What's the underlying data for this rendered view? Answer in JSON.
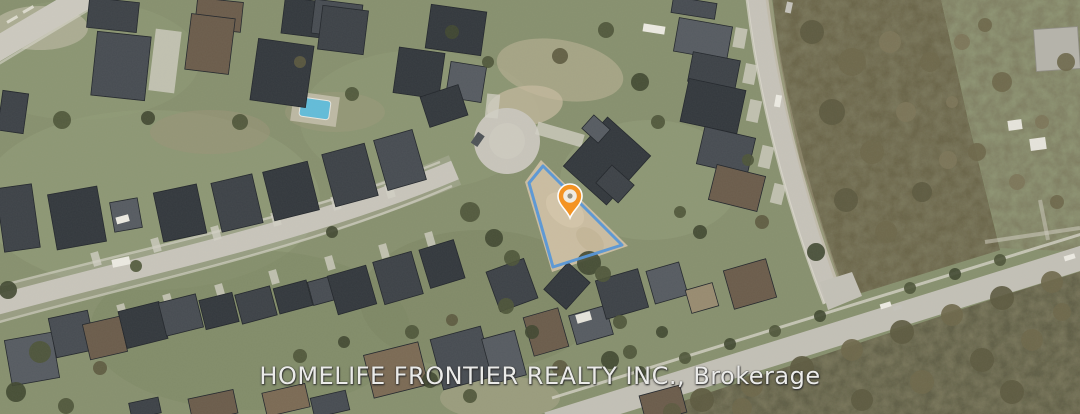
{
  "watermark": {
    "text": "HOMELIFE FRONTIER REALTY INC., Brokerage"
  },
  "parcel": {
    "outline_points": "543,166 622,245 553,267 529,183",
    "outline_color": "#5596d8"
  },
  "marker": {
    "transform": "translate(570,197)",
    "color": "#f6921e",
    "x": 570,
    "y": 197
  },
  "colors": {
    "ground": "#87906e",
    "road": "#c8c5bb",
    "woods_dense": "#6b6549",
    "woods_south": "#615e46",
    "scrub_field": "#8d9372",
    "house_roof_dark": "#33383d",
    "pool": "#62bcd9"
  }
}
